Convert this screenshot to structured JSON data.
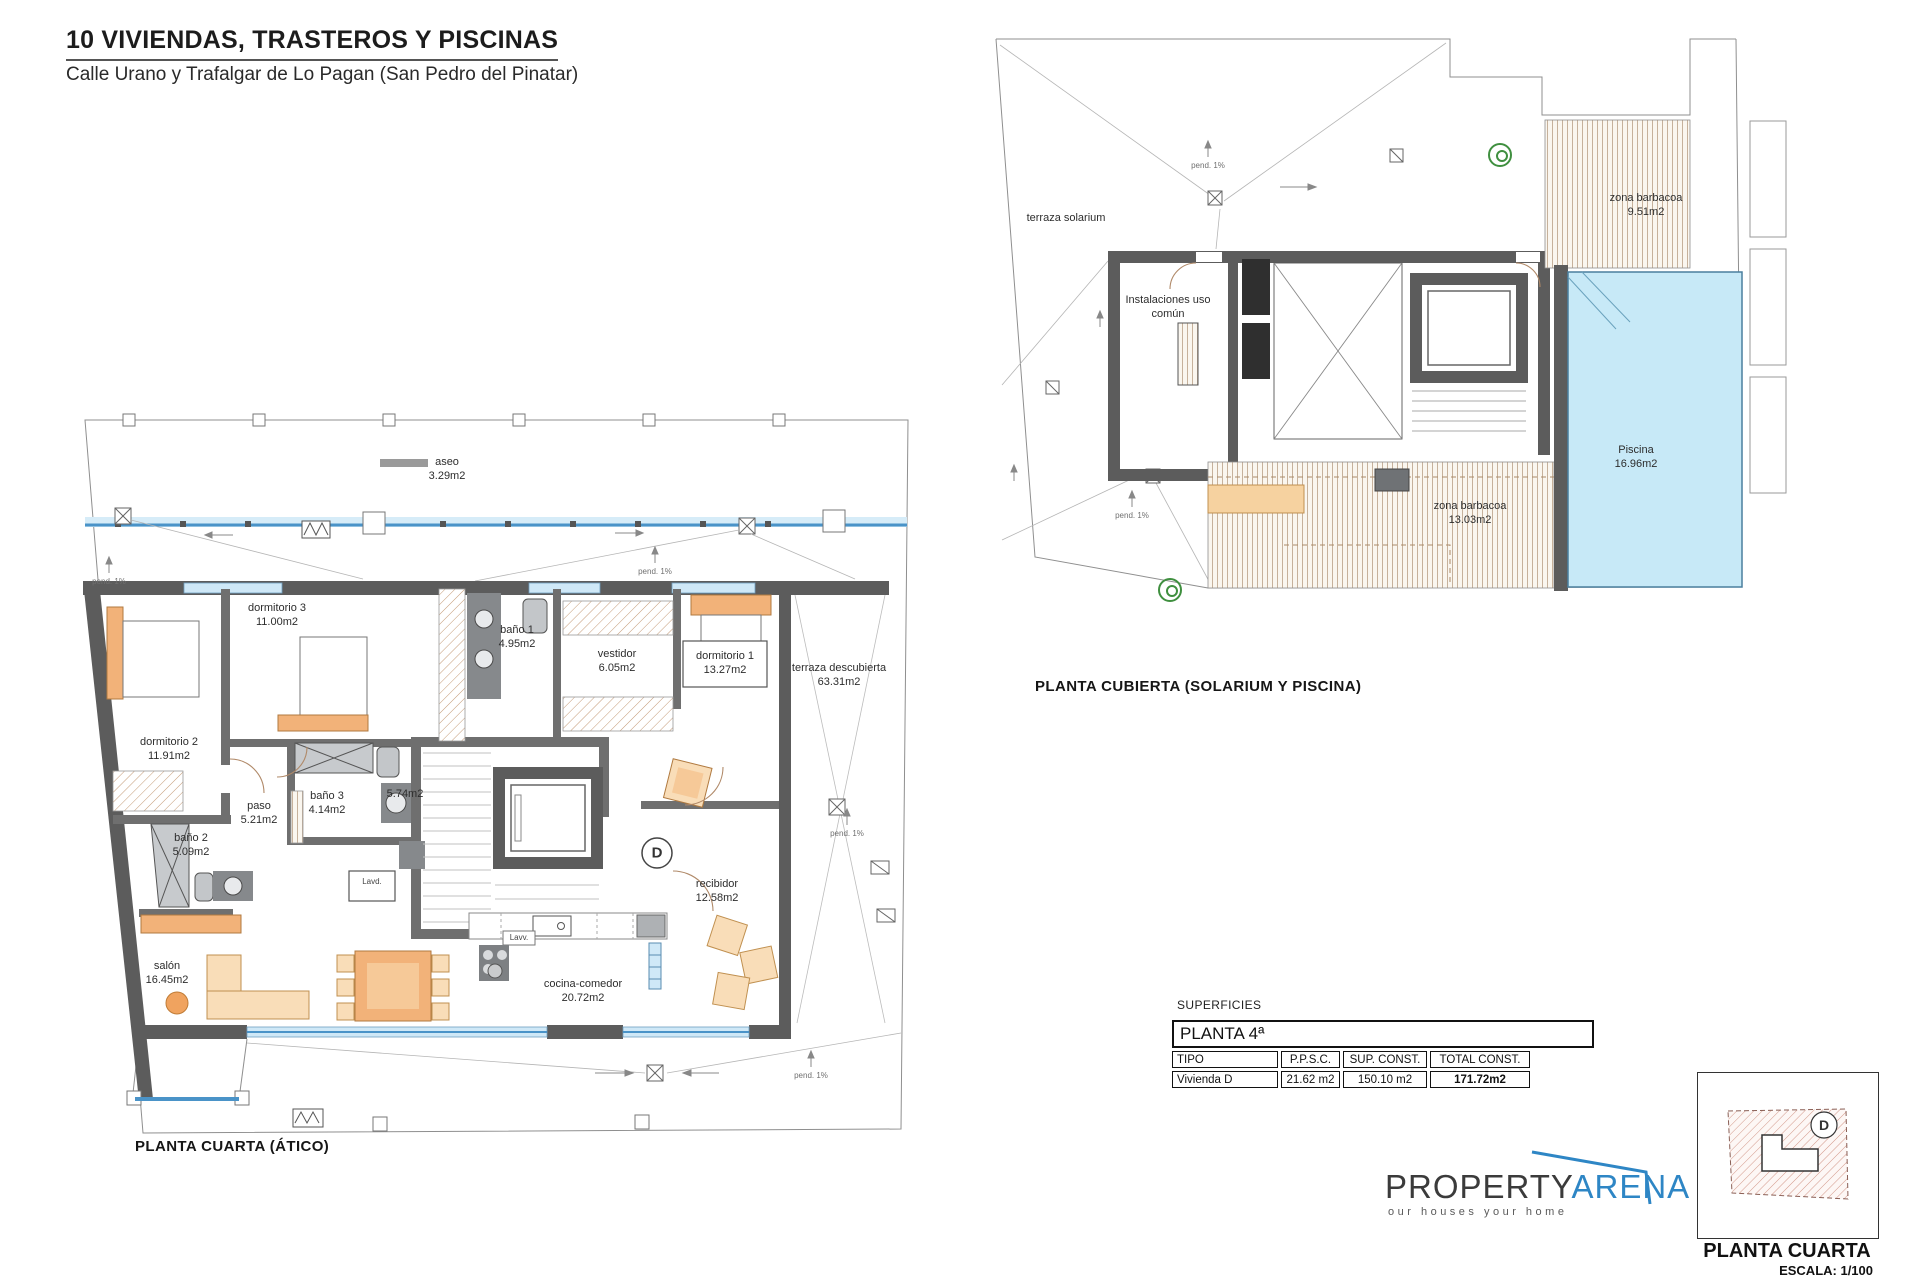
{
  "header": {
    "title": "10 VIVIENDAS, TRASTEROS Y PISCINAS",
    "subtitle": "Calle Urano y Trafalgar de Lo Pagan (San Pedro del Pinatar)"
  },
  "plans": {
    "atico": {
      "caption": "PLANTA CUARTA (ÁTICO)",
      "unit_letter": "D",
      "rooms": [
        {
          "name": "aseo",
          "area": "3.29m2"
        },
        {
          "name": "dormitorio 3",
          "area": "11.00m2"
        },
        {
          "name": "baño 1",
          "area": "4.95m2"
        },
        {
          "name": "vestidor",
          "area": "6.05m2"
        },
        {
          "name": "dormitorio 1",
          "area": "13.27m2"
        },
        {
          "name": "terraza descubierta",
          "area": "63.31m2"
        },
        {
          "name": "dormitorio 2",
          "area": "11.91m2"
        },
        {
          "name": "paso",
          "area": "5.21m2"
        },
        {
          "name": "baño 3",
          "area": "4.14m2"
        },
        {
          "name": "baño 2",
          "area": "5.09m2"
        },
        {
          "name": "salón",
          "area": "16.45m2"
        },
        {
          "name": "",
          "area": "5.74m2"
        },
        {
          "name": "recibidor",
          "area": "12.58m2"
        },
        {
          "name": "cocina-comedor",
          "area": "20.72m2"
        }
      ],
      "annotations": {
        "slope": "pend. 1%",
        "washer": "Lavd.",
        "dishwasher": "Lavv."
      }
    },
    "cubierta": {
      "caption": "PLANTA CUBIERTA (SOLARIUM Y PISCINA)",
      "rooms": [
        {
          "name": "terraza solarium",
          "area": ""
        },
        {
          "name": "Instalaciones uso común",
          "area": ""
        },
        {
          "name": "zona barbacoa",
          "area": "9.51m2"
        },
        {
          "name": "Piscina",
          "area": "16.96m2"
        },
        {
          "name": "zona barbacoa",
          "area": "13.03m2"
        }
      ],
      "annotations": {
        "slope": "pend. 1%"
      }
    }
  },
  "surfaces_table": {
    "section_label": "SUPERFICIES",
    "floor_header": "PLANTA 4ª",
    "columns": [
      "TIPO",
      "P.P.S.C.",
      "SUP. CONST.",
      "TOTAL CONST."
    ],
    "rows": [
      {
        "tipo": "Vivienda D",
        "ppsc": "21.62 m2",
        "sup": "150.10 m2",
        "total": "171.72m2"
      }
    ]
  },
  "logo": {
    "brand_primary": "PROPERTY",
    "brand_secondary": "ARENA",
    "tagline": "our houses your home",
    "accent_color": "#2e86c5"
  },
  "key_plan": {
    "unit_letter": "D",
    "caption": "PLANTA CUARTA",
    "scale": "ESCALA: 1/100"
  },
  "colors": {
    "wall": "#5c5c5c",
    "glazing": "#4a93c8",
    "pool": "#c7e9f7",
    "furniture": "#f2b279",
    "furniture_light": "#f9ddb8",
    "logo_blue": "#2e86c5"
  }
}
